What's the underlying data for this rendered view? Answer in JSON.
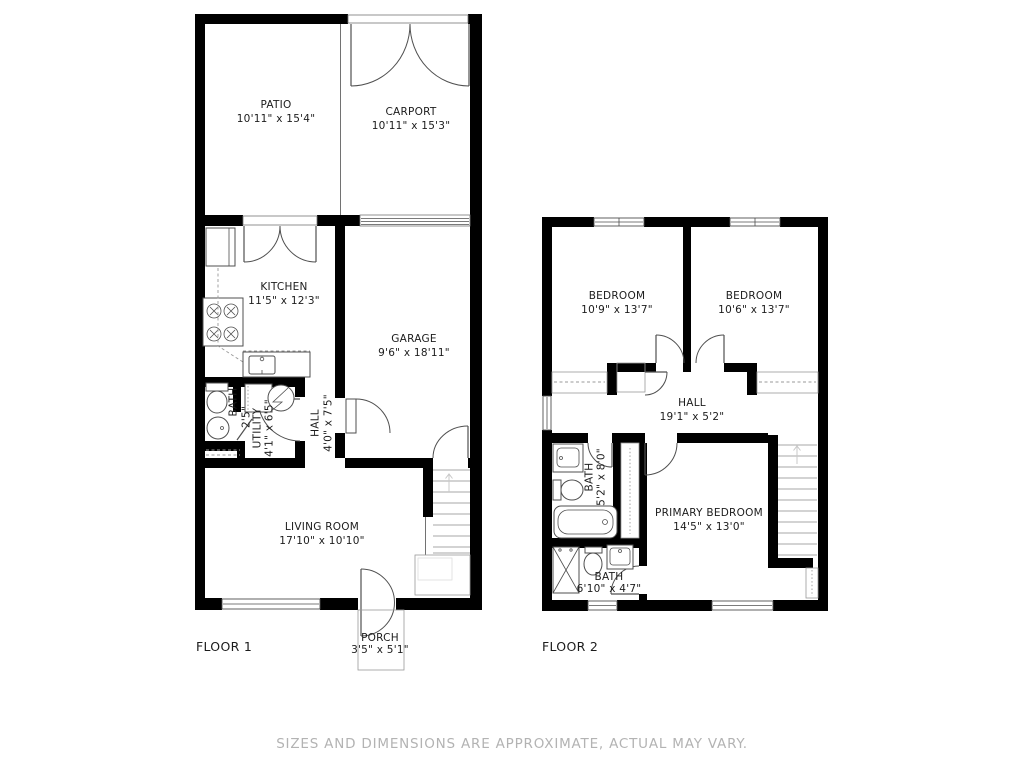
{
  "colors": {
    "background": "#ffffff",
    "wall": "#000000",
    "line": "#4f4f4f",
    "dash": "#999999",
    "text": "#1c1c1c",
    "muted": "#b3b3b3",
    "faint": "#c8c8c8"
  },
  "floor1": {
    "label": "FLOOR 1",
    "rooms": {
      "patio": {
        "name": "PATIO",
        "dims": "10'11\" x 15'4\""
      },
      "carport": {
        "name": "CARPORT",
        "dims": "10'11\" x 15'3\""
      },
      "kitchen": {
        "name": "KITCHEN",
        "dims": "11'5\" x 12'3\""
      },
      "garage": {
        "name": "GARAGE",
        "dims": "9'6\" x 18'11\""
      },
      "bath": {
        "name": "BATH",
        "dims": "2'5\""
      },
      "utility": {
        "name": "UTILITY",
        "dims": "4'1\" x 6'5\""
      },
      "hall": {
        "name": "HALL",
        "dims": "4'0\" x 7'5\""
      },
      "living_room": {
        "name": "LIVING ROOM",
        "dims": "17'10\" x 10'10\""
      },
      "porch": {
        "name": "PORCH",
        "dims": "3'5\" x 5'1\""
      }
    }
  },
  "floor2": {
    "label": "FLOOR 2",
    "rooms": {
      "bedroom_left": {
        "name": "BEDROOM",
        "dims": "10'9\" x 13'7\""
      },
      "bedroom_right": {
        "name": "BEDROOM",
        "dims": "10'6\" x 13'7\""
      },
      "hall": {
        "name": "HALL",
        "dims": "19'1\" x 5'2\""
      },
      "bath_upper": {
        "name": "BATH",
        "dims": "5'2\" x 8'0\""
      },
      "primary_bedroom": {
        "name": "PRIMARY BEDROOM",
        "dims": "14'5\" x 13'0\""
      },
      "bath_lower": {
        "name": "BATH",
        "dims": "6'10\" x 4'7\""
      }
    }
  },
  "footer": {
    "disclaimer": "SIZES AND DIMENSIONS ARE APPROXIMATE, ACTUAL MAY VARY."
  }
}
